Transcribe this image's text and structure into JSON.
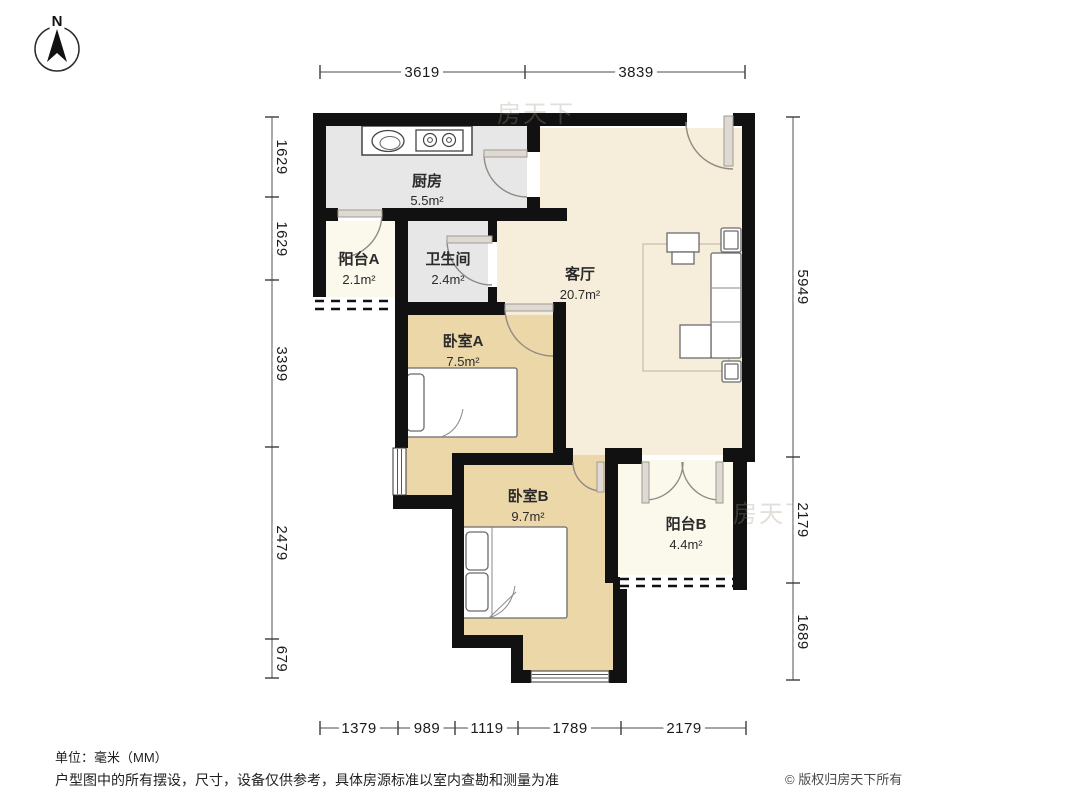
{
  "compass": {
    "label": "N"
  },
  "watermark": {
    "text": "房天下"
  },
  "rooms": [
    {
      "id": "kitchen",
      "name": "厨房",
      "area": "5.5m²"
    },
    {
      "id": "balcony_a",
      "name": "阳台A",
      "area": "2.1m²"
    },
    {
      "id": "bathroom",
      "name": "卫生间",
      "area": "2.4m²"
    },
    {
      "id": "living",
      "name": "客厅",
      "area": "20.7m²"
    },
    {
      "id": "bedroom_a",
      "name": "卧室A",
      "area": "7.5m²"
    },
    {
      "id": "bedroom_b",
      "name": "卧室B",
      "area": "9.7m²"
    },
    {
      "id": "balcony_b",
      "name": "阳台B",
      "area": "4.4m²"
    }
  ],
  "dimensions": {
    "top": [
      "3619",
      "3839"
    ],
    "left": [
      "1629",
      "1629",
      "3399",
      "2479",
      "679"
    ],
    "right": [
      "5949",
      "2179",
      "1689"
    ],
    "bottom": [
      "1379",
      "989",
      "1119",
      "1789",
      "2179"
    ]
  },
  "footer": {
    "units": "单位：毫米（MM）",
    "disclaimer": "户型图中的所有摆设，尺寸，设备仅供参考，具体房源标准以室内查勘和测量为准",
    "copyright": "© 版权归房天下所有"
  },
  "colors": {
    "wall": "#111111",
    "living_floor": "#f6edda",
    "bedroom_floor": "#ecd7a8",
    "service_floor": "#e7e7e7",
    "balcony_floor": "#fbf8ec"
  }
}
